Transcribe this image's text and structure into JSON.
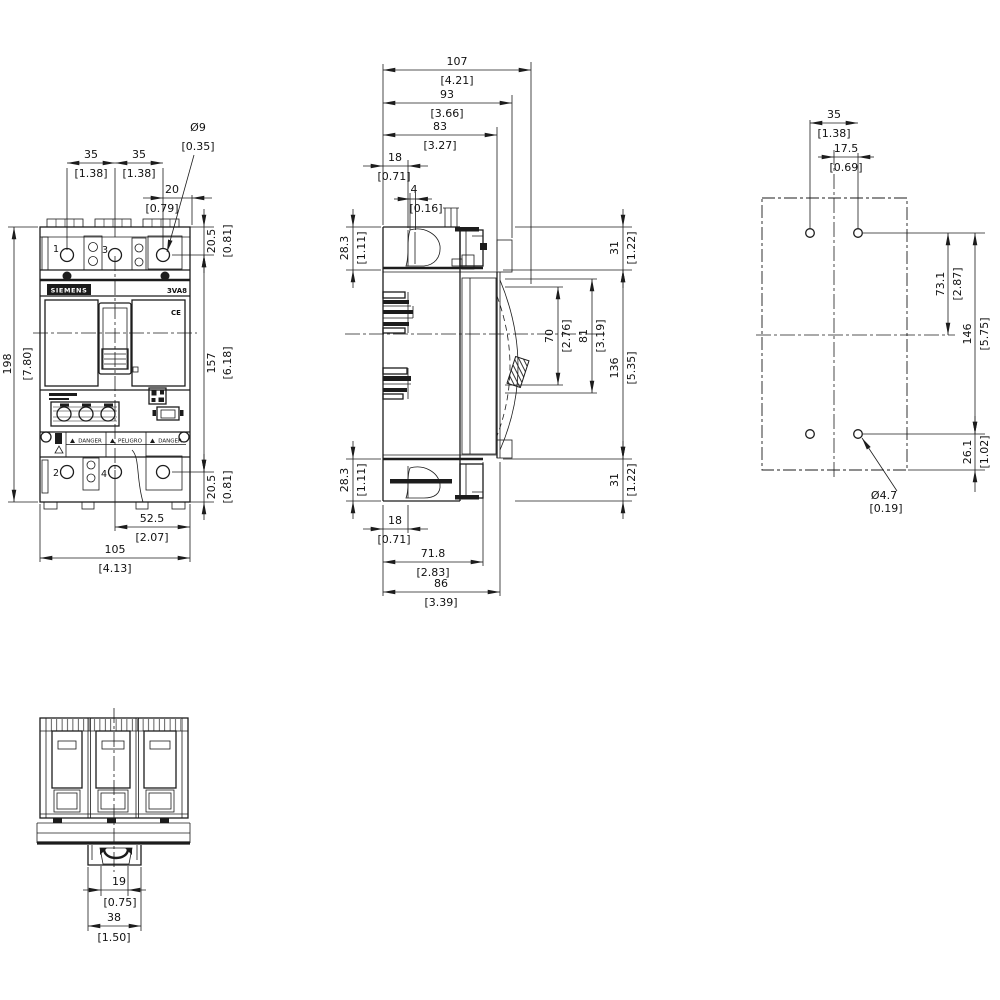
{
  "product": {
    "brand": "SIEMENS",
    "model": "3VA8",
    "ce_mark": "CE",
    "terminal_1": "1",
    "terminal_2": "2",
    "terminal_3": "3",
    "terminal_4": "4",
    "warning_1": "DANGER",
    "warning_2": "PELIGRO",
    "warning_3": "DANGER"
  },
  "views": {
    "front": {
      "dims": {
        "pitch_left": {
          "mm": "35",
          "in": "[1.38]"
        },
        "pitch_right": {
          "mm": "35",
          "in": "[1.38]"
        },
        "hole_dia": {
          "mm": "Ø9",
          "in": "[0.35]"
        },
        "hole_offset": {
          "mm": "20",
          "in": "[0.79]"
        },
        "top_margin": {
          "mm": "20.5",
          "in": "[0.81]"
        },
        "overall_height": {
          "mm": "198",
          "in": "[7.80]"
        },
        "inner_height": {
          "mm": "157",
          "in": "[6.18]"
        },
        "bottom_margin": {
          "mm": "20.5",
          "in": "[0.81]"
        },
        "half_width": {
          "mm": "52.5",
          "in": "[2.07]"
        },
        "overall_width": {
          "mm": "105",
          "in": "[4.13]"
        }
      }
    },
    "side": {
      "dims": {
        "depth_107": {
          "mm": "107",
          "in": "[4.21]"
        },
        "depth_93": {
          "mm": "93",
          "in": "[3.66]"
        },
        "depth_83": {
          "mm": "83",
          "in": "[3.27]"
        },
        "top_18": {
          "mm": "18",
          "in": "[0.71]"
        },
        "step_4": {
          "mm": "4",
          "in": "[0.16]"
        },
        "top_28_3": {
          "mm": "28.3",
          "in": "[1.11]"
        },
        "top_31": {
          "mm": "31",
          "in": "[1.22]"
        },
        "cut_70": {
          "mm": "70",
          "in": "[2.76]"
        },
        "cut_81": {
          "mm": "81",
          "in": "[3.19]"
        },
        "front_136": {
          "mm": "136",
          "in": "[5.35]"
        },
        "bot_28_3": {
          "mm": "28.3",
          "in": "[1.11]"
        },
        "bot_31": {
          "mm": "31",
          "in": "[1.22]"
        },
        "bot_18": {
          "mm": "18",
          "in": "[0.71]"
        },
        "depth_71_8": {
          "mm": "71.8",
          "in": "[2.83]"
        },
        "depth_86": {
          "mm": "86",
          "in": "[3.39]"
        }
      }
    },
    "drill": {
      "dims": {
        "pitch_35": {
          "mm": "35",
          "in": "[1.38]"
        },
        "half_17_5": {
          "mm": "17.5",
          "in": "[0.69]"
        },
        "upper_73_1": {
          "mm": "73.1",
          "in": "[2.87]"
        },
        "span_146": {
          "mm": "146",
          "in": "[5.75]"
        },
        "lower_26_1": {
          "mm": "26.1",
          "in": "[1.02]"
        },
        "hole_dia": {
          "mm": "Ø4.7",
          "in": "[0.19]"
        }
      }
    },
    "bottom": {
      "dims": {
        "slot_19": {
          "mm": "19",
          "in": "[0.75]"
        },
        "foot_38": {
          "mm": "38",
          "in": "[1.50]"
        }
      }
    }
  }
}
